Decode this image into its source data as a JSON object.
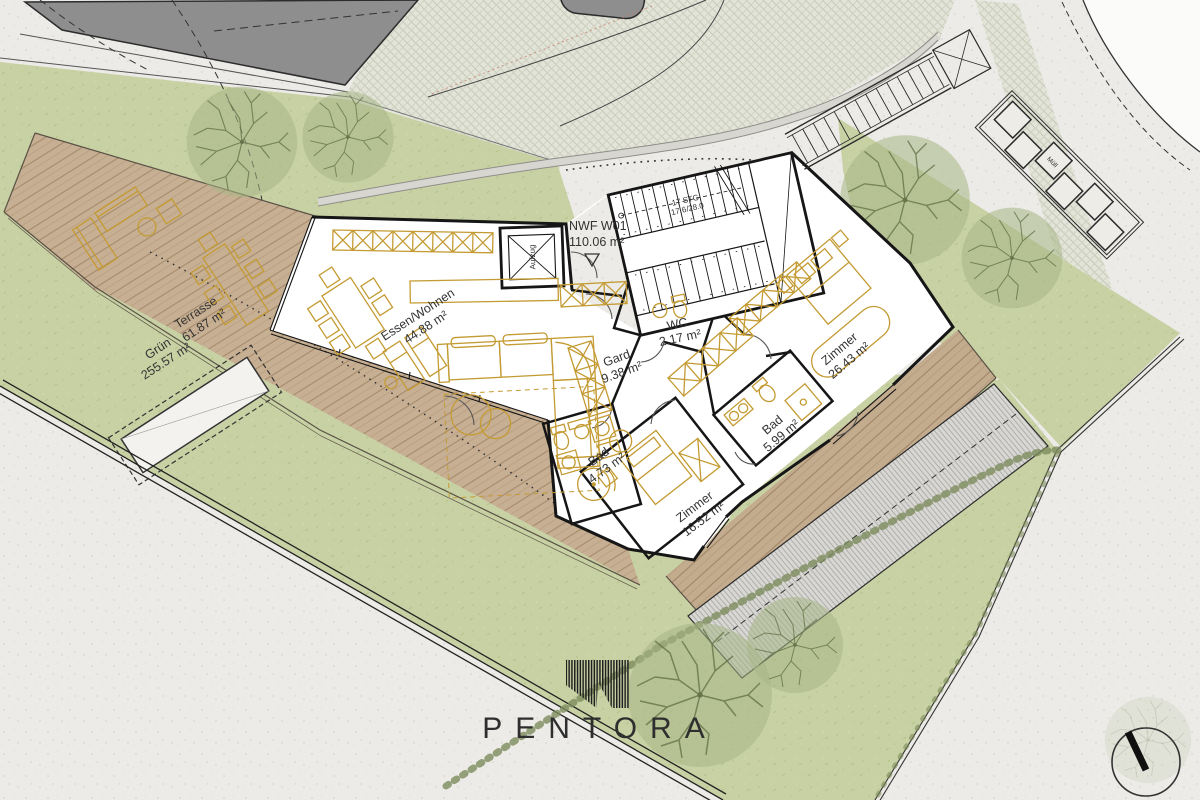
{
  "plan": {
    "site": {
      "gruen": {
        "name": "Grün",
        "area": "255.57 m²"
      },
      "terrasse": {
        "name": "Terrasse",
        "area": "61.87 m²"
      },
      "nwf": {
        "name": "NWF W01",
        "area": "110.06 m²"
      },
      "muell": {
        "name": "Müll"
      }
    },
    "rooms": {
      "wohnen": {
        "name": "Essen/Wohnen",
        "area": "44.88 m²"
      },
      "gard": {
        "name": "Gard",
        "area": "9.38 m²"
      },
      "wc": {
        "name": "WC",
        "area": "2.17 m²"
      },
      "zimmer_gross": {
        "name": "Zimmer",
        "area": "26.43 m²"
      },
      "bad_gross": {
        "name": "Bad",
        "area": "5.99 m²"
      },
      "bad_klein": {
        "name": "Bad",
        "area": "4.73 m²"
      },
      "zimmer_klein": {
        "name": "Zimmer",
        "area": "16.52 m²"
      },
      "aufzug": {
        "name": "Aufzug"
      }
    },
    "stairs": {
      "steps": "17 STG",
      "dim": "17.6/28.0"
    },
    "logo": {
      "wordmark": "PENTORA"
    },
    "colors": {
      "grass": "#c8d1a4",
      "wood": "#c7af93",
      "furniture_gold": "#c49b33",
      "dark_building": "#8e8e8e",
      "paving": "#ecebe7",
      "walls": "#161616",
      "tree": "#a7b687",
      "hedge": "#7d8c5c"
    }
  }
}
